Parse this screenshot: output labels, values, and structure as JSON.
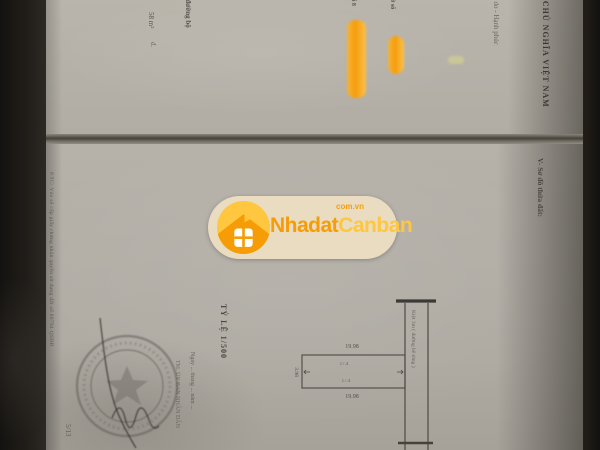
{
  "watermark": {
    "brand_primary": "Nhadat",
    "brand_secondary": "Canban",
    "domain_label": "com.vn",
    "colors": {
      "orange": "#f59c06",
      "yellow": "#ffc63f",
      "pill": "#e9dcc1"
    }
  },
  "document": {
    "top_page": {
      "header_line1": "CỘNG HÒA XÃ HỘI CHỦ NGHĨA VIỆT NAM",
      "header_line2": "Độc lập - Tự do - Hạnh phúc",
      "fragment_area": "58 m²",
      "fragment_unit": "đ.",
      "fragment_road": "g đường bộ",
      "highlight1_label": "số 8",
      "highlight2_label": "tờ số"
    },
    "main_page": {
      "section_v": "V- Sơ đồ thửa đất:",
      "scale_label": "TỶ LỆ 1/500",
      "registry_line": "P.TC: Vào sổ cấp giấy chứng nhận quyền sử dụng đất số 00794 QSDĐ",
      "date_line": "Ngày ... tháng ... năm ...",
      "sig_title": "TM. ỦY BAN NHÂN DÂN",
      "corner_note": "5/13",
      "diagram": {
        "width_top": "19.98",
        "width_bottom": "19.98",
        "depth_left": "3.98",
        "inner_top": "17.4",
        "inner_bottom": "17.4",
        "road_label": "Kiệt 3m ( đường bê tông )"
      }
    }
  },
  "photo": {
    "paper_color": "#b4b0a8",
    "background_color": "#26241f",
    "highlight_color": "#f59d0c"
  }
}
